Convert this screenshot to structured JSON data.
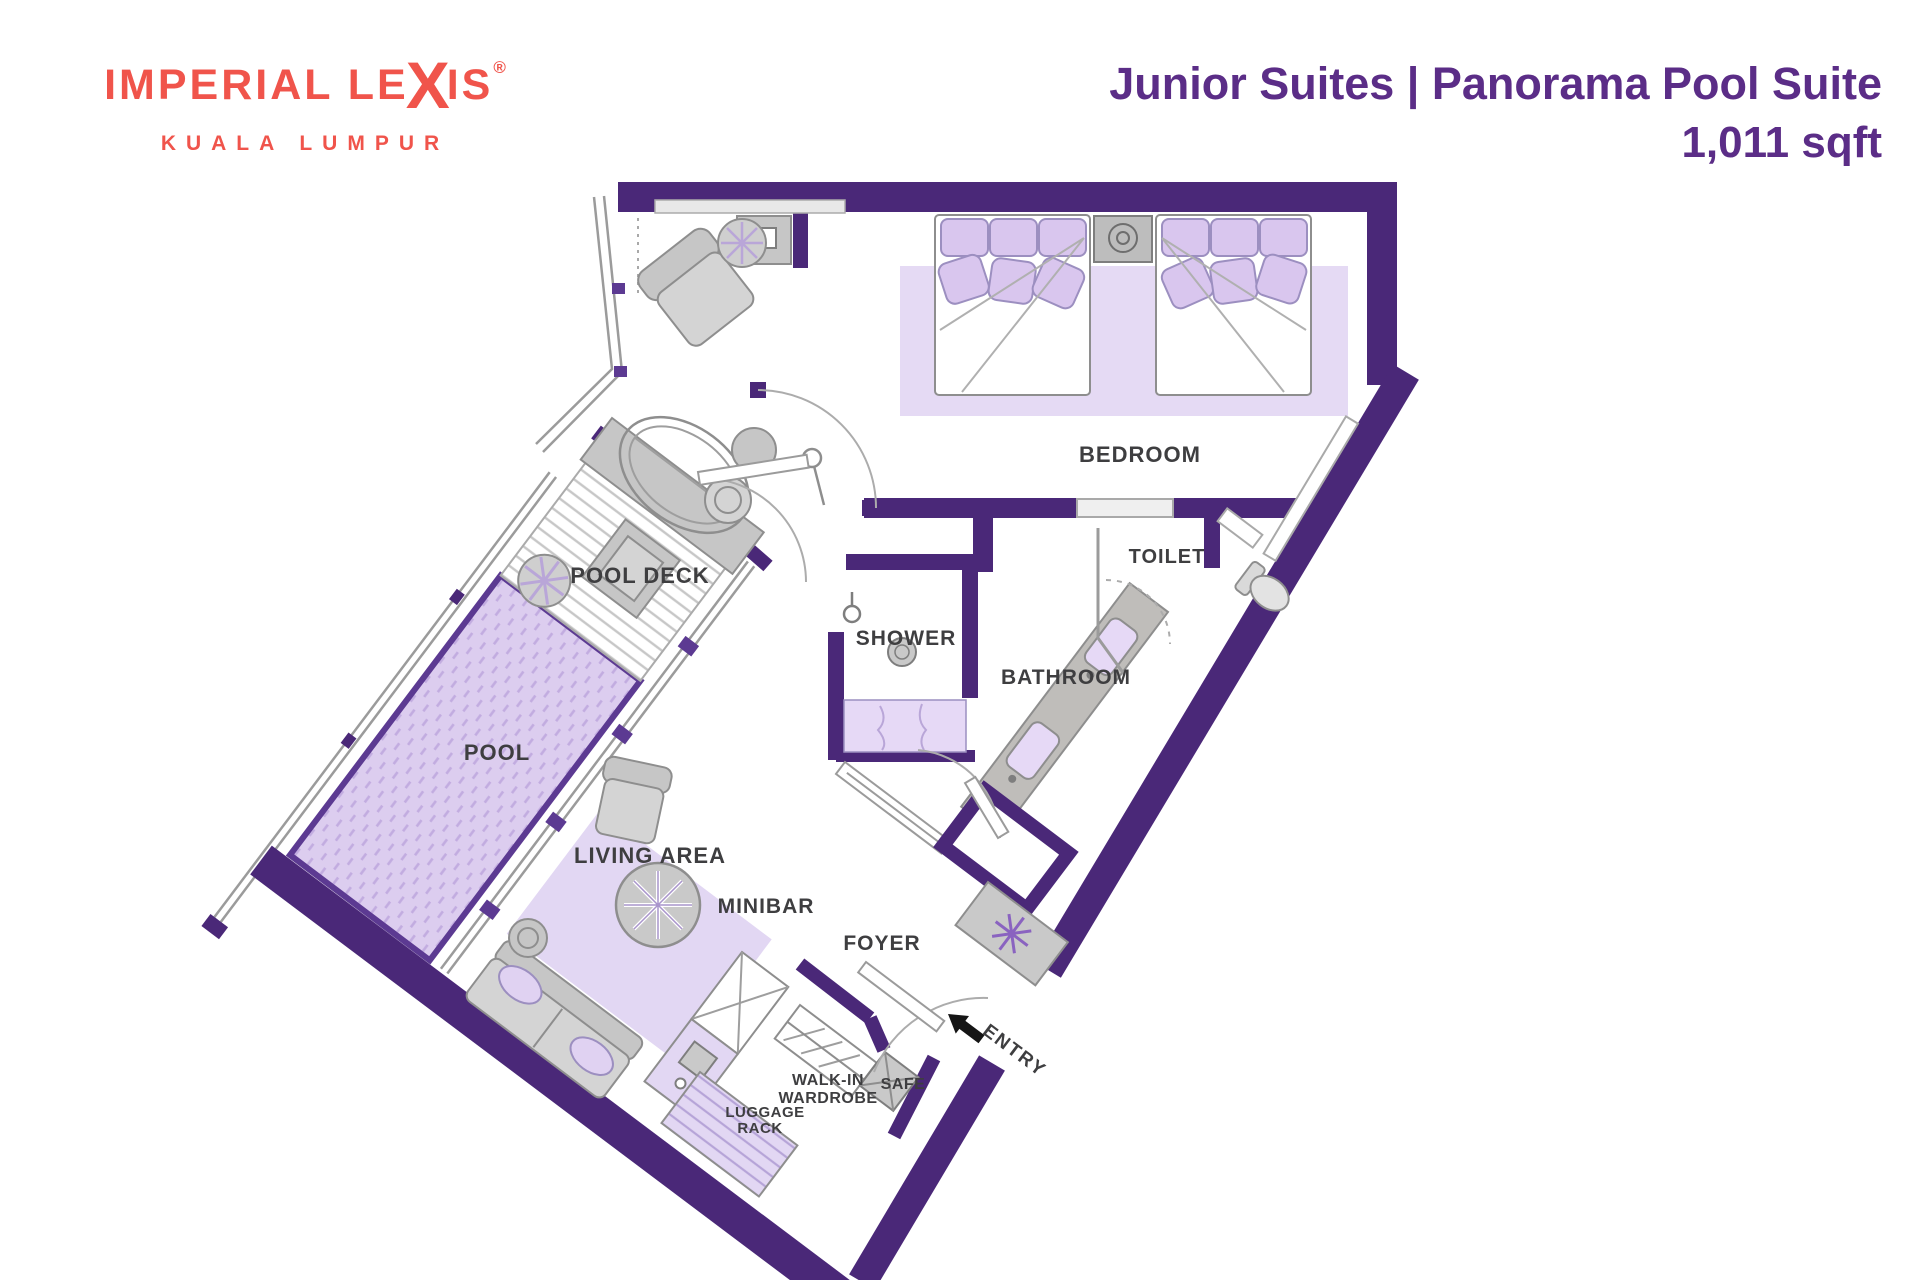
{
  "brand": {
    "wordmark_prefix": "IMPERIAL LE",
    "wordmark_x": "X",
    "wordmark_suffix": "IS",
    "registered": "®",
    "city": "KUALA LUMPUR"
  },
  "header": {
    "title": "Junior Suites | Panorama Pool Suite",
    "area": "1,011 sqft"
  },
  "floorplan": {
    "labels": {
      "bedroom": "BEDROOM",
      "toilet": "TOILET",
      "shower": "SHOWER",
      "bathroom": "BATHROOM",
      "pool_deck": "POOL DECK",
      "pool": "POOL",
      "living_area": "LIVING AREA",
      "minibar": "MINIBAR",
      "foyer": "FOYER",
      "wardrobe_line1": "WALK-IN",
      "wardrobe_line2": "WARDROBE",
      "safe": "SAFE",
      "luggage_line1": "LUGGAGE",
      "luggage_line2": "RACK",
      "entry": "ENTRY"
    }
  },
  "colors": {
    "wall": "#4A2878",
    "accent": "#5C3A92",
    "lav": "#DDCFF0",
    "lav2": "#D9C6EE",
    "lavdk": "#C7B2E6",
    "title": "#5B2D87",
    "coral": "#F0544B",
    "label": "#3E3E40",
    "furn": "#C6C6C6"
  }
}
